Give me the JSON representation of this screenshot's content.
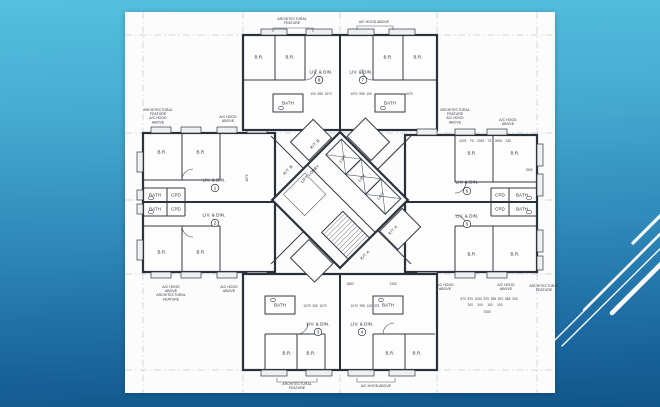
{
  "theme": {
    "background_top": "#55c0df",
    "background_bottom": "#115689",
    "panel_background": "#fcfcfd",
    "drawing_ink": "#2b313a",
    "decor_line_color": "#ffffff"
  },
  "plan": {
    "units": [
      {
        "n": "1",
        "x": 90,
        "y": 176
      },
      {
        "n": "2",
        "x": 90,
        "y": 211
      },
      {
        "n": "3",
        "x": 193,
        "y": 320
      },
      {
        "n": "4",
        "x": 237,
        "y": 320
      },
      {
        "n": "5",
        "x": 342,
        "y": 212
      },
      {
        "n": "6",
        "x": 342,
        "y": 179
      },
      {
        "n": "7",
        "x": 238,
        "y": 68
      },
      {
        "n": "8",
        "x": 194,
        "y": 68
      }
    ],
    "labels": [
      {
        "t": "B.R.",
        "x": 37,
        "y": 140,
        "c": "room"
      },
      {
        "t": "B.R.",
        "x": 76,
        "y": 140,
        "c": "room"
      },
      {
        "t": "B.R.",
        "x": 37,
        "y": 240,
        "c": "room"
      },
      {
        "t": "B.R.",
        "x": 76,
        "y": 240,
        "c": "room"
      },
      {
        "t": "LIV. & DIN.",
        "x": 89,
        "y": 168,
        "c": "room"
      },
      {
        "t": "LIV. & DIN.",
        "x": 89,
        "y": 203,
        "c": "room"
      },
      {
        "t": "BATH",
        "x": 30,
        "y": 183,
        "c": "room"
      },
      {
        "t": "CPD",
        "x": 51,
        "y": 183,
        "c": "room"
      },
      {
        "t": "BATH",
        "x": 30,
        "y": 197,
        "c": "room"
      },
      {
        "t": "CPD",
        "x": 51,
        "y": 197,
        "c": "room"
      },
      {
        "t": "B.R.",
        "x": 134,
        "y": 45,
        "c": "room"
      },
      {
        "t": "B.R.",
        "x": 165,
        "y": 45,
        "c": "room"
      },
      {
        "t": "B.R.",
        "x": 263,
        "y": 45,
        "c": "room"
      },
      {
        "t": "B.R.",
        "x": 293,
        "y": 45,
        "c": "room"
      },
      {
        "t": "LIV. & DIN.",
        "x": 196,
        "y": 60,
        "c": "room"
      },
      {
        "t": "LIV. & DIN.",
        "x": 236,
        "y": 60,
        "c": "room"
      },
      {
        "t": "BATH",
        "x": 163,
        "y": 91,
        "c": "room"
      },
      {
        "t": "BATH",
        "x": 265,
        "y": 91,
        "c": "room"
      },
      {
        "t": "B.R.",
        "x": 347,
        "y": 141,
        "c": "room"
      },
      {
        "t": "B.R.",
        "x": 390,
        "y": 141,
        "c": "room"
      },
      {
        "t": "B.R.",
        "x": 347,
        "y": 242,
        "c": "room"
      },
      {
        "t": "B.R.",
        "x": 390,
        "y": 242,
        "c": "room"
      },
      {
        "t": "LIV. & DIN.",
        "x": 342,
        "y": 170,
        "c": "room"
      },
      {
        "t": "LIV. & DIN.",
        "x": 342,
        "y": 204,
        "c": "room"
      },
      {
        "t": "CPD",
        "x": 375,
        "y": 183,
        "c": "room"
      },
      {
        "t": "BATH",
        "x": 397,
        "y": 183,
        "c": "room"
      },
      {
        "t": "CPD",
        "x": 375,
        "y": 197,
        "c": "room"
      },
      {
        "t": "BATH",
        "x": 397,
        "y": 197,
        "c": "room"
      },
      {
        "t": "BATH",
        "x": 155,
        "y": 293,
        "c": "room"
      },
      {
        "t": "BATH",
        "x": 263,
        "y": 293,
        "c": "room"
      },
      {
        "t": "LIV. & DIN.",
        "x": 193,
        "y": 312,
        "c": "room"
      },
      {
        "t": "LIV. & DIN.",
        "x": 237,
        "y": 312,
        "c": "room"
      },
      {
        "t": "B.R.",
        "x": 162,
        "y": 341,
        "c": "room"
      },
      {
        "t": "B.R.",
        "x": 186,
        "y": 341,
        "c": "room"
      },
      {
        "t": "B.R.",
        "x": 265,
        "y": 341,
        "c": "room"
      },
      {
        "t": "B.R.",
        "x": 292,
        "y": 341,
        "c": "room"
      },
      {
        "t": "LIFT LOBBY",
        "x": 185,
        "y": 162,
        "c": "core",
        "r": -45
      },
      {
        "t": "LIFT",
        "x": 218,
        "y": 147,
        "c": "core",
        "r": -45
      },
      {
        "t": "LIFT",
        "x": 237,
        "y": 166,
        "c": "core",
        "r": -45
      },
      {
        "t": "LIFT",
        "x": 256,
        "y": 184,
        "c": "core",
        "r": -45
      },
      {
        "t": "KIT. B",
        "x": 190,
        "y": 132,
        "c": "core",
        "r": -45
      },
      {
        "t": "KIT. B",
        "x": 163,
        "y": 158,
        "c": "core",
        "r": -45
      },
      {
        "t": "KIT. A",
        "x": 268,
        "y": 218,
        "c": "core",
        "r": -45
      },
      {
        "t": "KIT. A",
        "x": 240,
        "y": 243,
        "c": "core",
        "r": -45
      },
      {
        "t": "ARCHITECTURAL\nFEATURE\nA/C HOOD\nABOVE",
        "x": 33,
        "y": 104,
        "c": "note"
      },
      {
        "t": "A/C HOOD\nABOVE",
        "x": 103,
        "y": 107,
        "c": "note"
      },
      {
        "t": "ARCHITECTURAL\nFEATURE",
        "x": 167,
        "y": 9,
        "c": "note"
      },
      {
        "t": "A/C HOOD ABOVE",
        "x": 249,
        "y": 10,
        "c": "note"
      },
      {
        "t": "ARCHITECTURAL\nFEATURE\nA/C HOOD\nABOVE",
        "x": 330,
        "y": 104,
        "c": "note"
      },
      {
        "t": "A/C HOOD\nABOVE",
        "x": 383,
        "y": 110,
        "c": "note"
      },
      {
        "t": "A/C HOOD\nABOVE",
        "x": 320,
        "y": 275,
        "c": "note"
      },
      {
        "t": "A/C HOOD\nABOVE",
        "x": 381,
        "y": 275,
        "c": "note"
      },
      {
        "t": "ARCHITECTURAL\nFEATURE",
        "x": 419,
        "y": 276,
        "c": "note"
      },
      {
        "t": "A/C HOOD\nABOVE\nARCHITECTURAL\nFEATURE",
        "x": 46,
        "y": 281,
        "c": "note"
      },
      {
        "t": "A/C HOOD\nABOVE",
        "x": 104,
        "y": 277,
        "c": "note"
      },
      {
        "t": "ARCHITECTURAL\nFEATURE",
        "x": 172,
        "y": 374,
        "c": "note"
      },
      {
        "t": "A/C HOOD ABOVE",
        "x": 251,
        "y": 374,
        "c": "note"
      },
      {
        "t": "100  995  1070",
        "x": 196,
        "y": 82,
        "c": "dim"
      },
      {
        "t": "1070  995  100",
        "x": 236,
        "y": 82,
        "c": "dim"
      },
      {
        "t": "1075",
        "x": 284,
        "y": 82,
        "c": "dim"
      },
      {
        "t": "1075  205  1070",
        "x": 190,
        "y": 294,
        "c": "dim"
      },
      {
        "t": "1070  995  100  375",
        "x": 240,
        "y": 294,
        "c": "dim"
      },
      {
        "t": "2475    75    2025    75    2695    235",
        "x": 360,
        "y": 129,
        "c": "dim"
      },
      {
        "t": "870  870  1000  870  935  870  585  205",
        "x": 364,
        "y": 287,
        "c": "dim"
      },
      {
        "t": "100     100     100     100",
        "x": 360,
        "y": 293,
        "c": "dim"
      },
      {
        "t": "7505",
        "x": 362,
        "y": 300,
        "c": "dim"
      },
      {
        "t": "1530",
        "x": 404,
        "y": 158,
        "c": "dim"
      },
      {
        "t": "1075",
        "x": 122,
        "y": 166,
        "c": "dim",
        "r": -90
      },
      {
        "t": "1860",
        "x": 225,
        "y": 272,
        "c": "dim"
      },
      {
        "t": "1330",
        "x": 268,
        "y": 272,
        "c": "dim"
      }
    ]
  }
}
